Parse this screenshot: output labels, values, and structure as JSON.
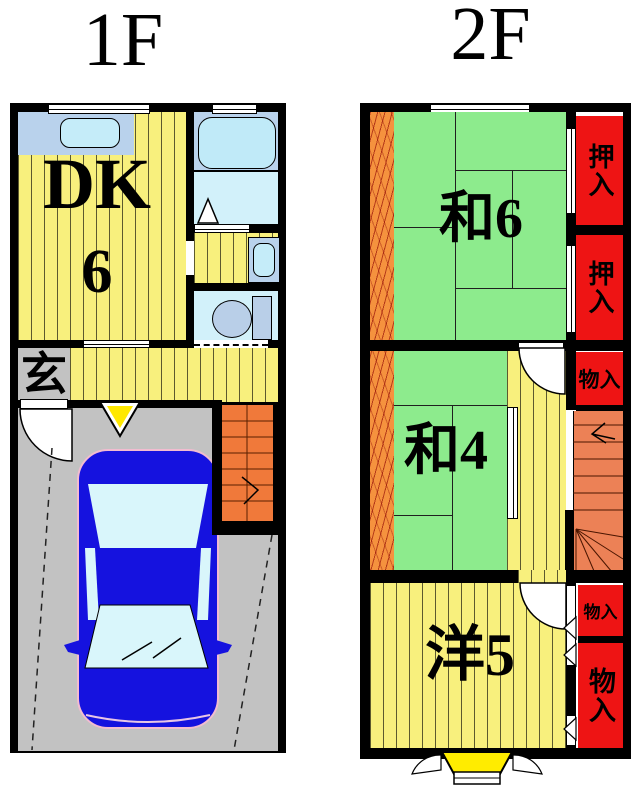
{
  "floor1": {
    "title": "1F",
    "rooms": {
      "dk": {
        "label": "DK",
        "size": "6"
      },
      "genkan": {
        "label": "玄"
      }
    }
  },
  "floor2": {
    "title": "2F",
    "rooms": {
      "washitsu6": {
        "label": "和6"
      },
      "washitsu4": {
        "label": "和4"
      },
      "youshitsu5": {
        "label": "洋5"
      }
    },
    "closets": [
      {
        "label": "押入"
      },
      {
        "label": "押入"
      },
      {
        "label": "物入"
      },
      {
        "label": "物入"
      },
      {
        "label": "物入"
      }
    ]
  },
  "colors": {
    "wall": "#000000",
    "floor_yellow": "#f8f07d",
    "tatami_green": "#8deb8d",
    "closet_red": "#ee1414",
    "stairs_orange_1f": "#f0793a",
    "stairs_salmon_2f": "#ec8156",
    "balcony_wood_orange": "#f5923e",
    "garage_gray": "#c2c2c2",
    "counter_blue": "#b9d2ec",
    "fixture_cyan": "#c5ecf9",
    "wetroom_cyan": "#d2f1fa",
    "car_blue": "#1512df",
    "car_window_cyan": "#d9f6fb",
    "entrance_marker_yellow": "#ffe800",
    "bay_window_yellow": "#ffec00"
  }
}
